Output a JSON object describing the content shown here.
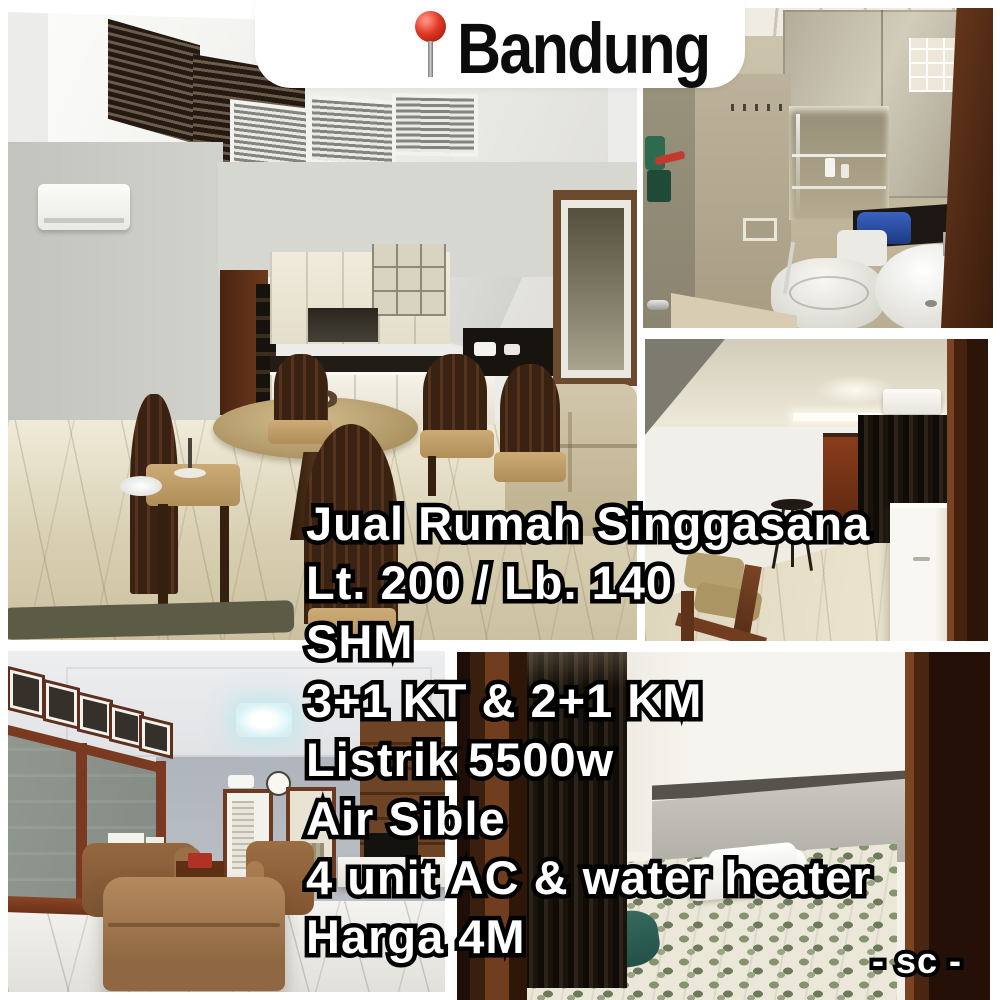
{
  "banner": {
    "location": "Bandung",
    "pin_icon": "round-pushpin-icon"
  },
  "listing": {
    "lines": [
      "Jual Rumah Singgasana",
      "Lt. 200 / Lb. 140",
      "SHM",
      "3+1 KT & 2+1 KM",
      "Listrik 5500w",
      "Air Sible",
      "4 unit AC & water heater",
      "Harga 4M"
    ]
  },
  "watermark": {
    "text": "- sc -"
  },
  "colors": {
    "page_bg": "#ffffff",
    "banner_bg": "#ffffff",
    "banner_text": "#0c0c0c",
    "pin_red": "#e23a28",
    "overlay_fill": "#ffffff",
    "overlay_stroke": "#000000"
  }
}
